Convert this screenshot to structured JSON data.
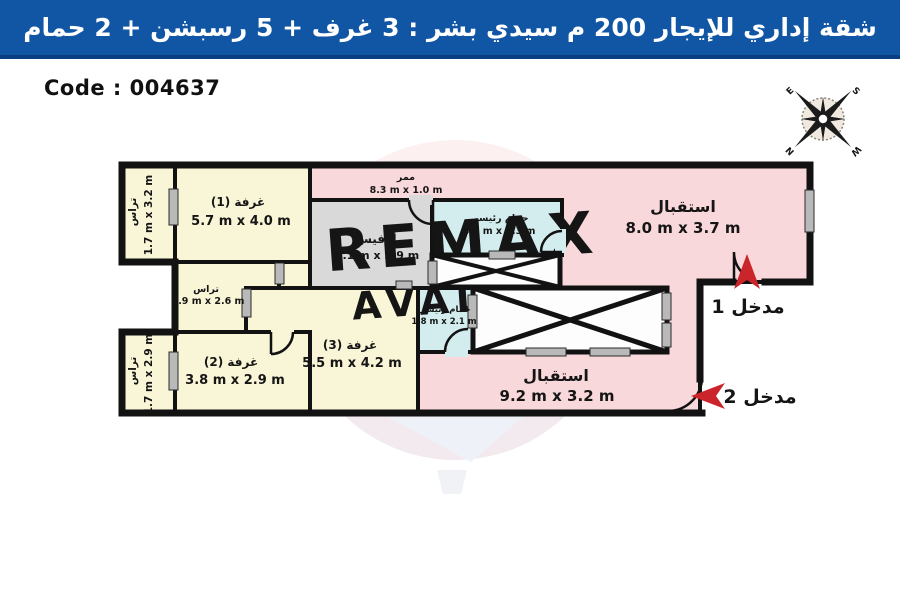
{
  "header": {
    "title": "شقة إداري للإيجار 200 م سيدي بشر :  3 غرف + 5 رسبشن + 2 حمام"
  },
  "code_label": "Code : 004637",
  "compass": {
    "n": "N",
    "e": "E",
    "s": "S",
    "w": "W"
  },
  "rooms": {
    "corridor": {
      "name": "ممر",
      "dims": "8.3 m x 1.0 m"
    },
    "reception1": {
      "name": "استقبال",
      "dims": "8.0 m x 3.7 m"
    },
    "reception2": {
      "name": "استقبال",
      "dims": "9.2 m x 3.2 m"
    },
    "room1": {
      "name": "غرفة (1)",
      "dims": "5.7 m x 4.0 m"
    },
    "room2": {
      "name": "غرفة (2)",
      "dims": "3.8 m x 2.9 m"
    },
    "room3": {
      "name": "غرفة (3)",
      "dims": "5.5 m x 4.2 m"
    },
    "office": {
      "name": "أوفيس",
      "dims": "4.1 m x 2.9 m"
    },
    "bath1": {
      "name": "حمام رئيسي",
      "dims": "4.0 m x 1.3 m"
    },
    "bath2": {
      "name": "حمام رئيسي",
      "dims": "1.8 m x 2.1 m"
    },
    "terrace_top": {
      "name": "تراس",
      "dims": "1.7 m x 3.2 m"
    },
    "terrace_mid": {
      "name": "تراس",
      "dims": "2.9 m x 2.6 m"
    },
    "terrace_bottom": {
      "name": "تراس",
      "dims": "1.7 m x 2.9 m"
    }
  },
  "entrances": {
    "e1": "مدخل 1",
    "e2": "مدخل 2"
  },
  "watermark": {
    "line1": "REMAX",
    "line2": "AVALON"
  },
  "colors": {
    "header_blue": "#1156a4",
    "header_edge": "#0b3e80",
    "reception_pink": "#f8d8db",
    "room_cream": "#f9f5d7",
    "office_gray": "#d9d9d9",
    "bath_blue": "#d3edee",
    "wall_black": "#121212",
    "window_gray": "#b9b9b9",
    "arrow_red": "#c9252b"
  }
}
